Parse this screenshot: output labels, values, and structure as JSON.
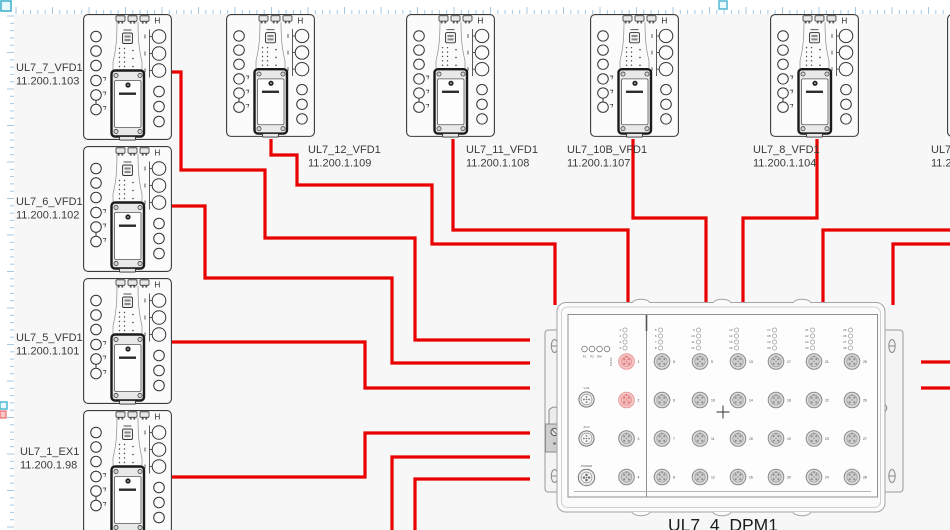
{
  "canvas": {
    "background": "#f7f7f7",
    "ruler_background": "#ffffff",
    "ruler_tick_color": "#a4c8e4",
    "handle_color": "#45b4cf",
    "marker_color": "#e86a6a",
    "wire_color": "#e90000"
  },
  "vfd_symbol": {
    "mark": "H"
  },
  "devices": [
    {
      "name": "UL7_7_VFD1",
      "ip": "11.200.1.103"
    },
    {
      "name": "UL7_6_VFD1",
      "ip": "11.200.1.102"
    },
    {
      "name": "UL7_5_VFD1",
      "ip": "11.200.1.101"
    },
    {
      "name": "UL7_1_EX1",
      "ip": "11.200.1.98"
    },
    {
      "name": "UL7_12_VFD1",
      "ip": "11.200.1.109"
    },
    {
      "name": "UL7_11_VFD1",
      "ip": "11.200.1.108"
    },
    {
      "name": "UL7_10B_VFD1",
      "ip": "11.200.1.107"
    },
    {
      "name": "UL7_8_VFD1",
      "ip": "11.200.1.104"
    },
    {
      "name": "UL7_",
      "ip": "11.2"
    }
  ],
  "switch": {
    "name": "UL7_4_DPM1",
    "status_leds": [
      "P1",
      "P2",
      "RM",
      "FAULT"
    ],
    "aux_ports": [
      "V.24",
      "ACA",
      "POWER"
    ],
    "port_columns": [
      [
        1,
        2,
        3,
        4
      ],
      [
        5,
        6,
        7,
        8
      ],
      [
        9,
        10,
        11,
        12
      ],
      [
        13,
        14,
        15,
        16
      ],
      [
        17,
        18,
        19,
        20
      ],
      [
        21,
        22,
        23,
        24
      ],
      [
        25,
        26,
        27,
        28
      ]
    ],
    "highlighted_ports": [
      1,
      2
    ]
  },
  "connections": [
    {
      "id": "w1",
      "from": "UL7_7_VFD1",
      "to": "UL7_4_DPM1"
    },
    {
      "id": "w2",
      "from": "UL7_6_VFD1",
      "to": "UL7_4_DPM1"
    },
    {
      "id": "w3",
      "from": "UL7_5_VFD1",
      "to": "UL7_4_DPM1"
    },
    {
      "id": "w4",
      "from": "UL7_1_EX1",
      "to": "UL7_4_DPM1"
    },
    {
      "id": "w5",
      "from": "UL7_12_VFD1",
      "to": "UL7_4_DPM1"
    },
    {
      "id": "w6",
      "from": "UL7_11_VFD1",
      "to": "UL7_4_DPM1"
    },
    {
      "id": "w7",
      "from": "UL7_10B_VFD1",
      "to": "UL7_4_DPM1"
    },
    {
      "id": "w8",
      "from": "UL7_8_VFD1",
      "to": "UL7_4_DPM1"
    },
    {
      "id": "w9",
      "from": "edge-right",
      "to": "UL7_4_DPM1"
    },
    {
      "id": "w10",
      "from": "edge-right",
      "to": "UL7_4_DPM1"
    },
    {
      "id": "w11",
      "from": "edge-bottom",
      "to": "UL7_4_DPM1"
    },
    {
      "id": "w12",
      "from": "edge-bottom",
      "to": "UL7_4_DPM1"
    },
    {
      "id": "w13",
      "from": "UL7_4_DPM1",
      "to": "edge-right"
    },
    {
      "id": "w14",
      "from": "UL7_4_DPM1",
      "to": "edge-right"
    }
  ]
}
